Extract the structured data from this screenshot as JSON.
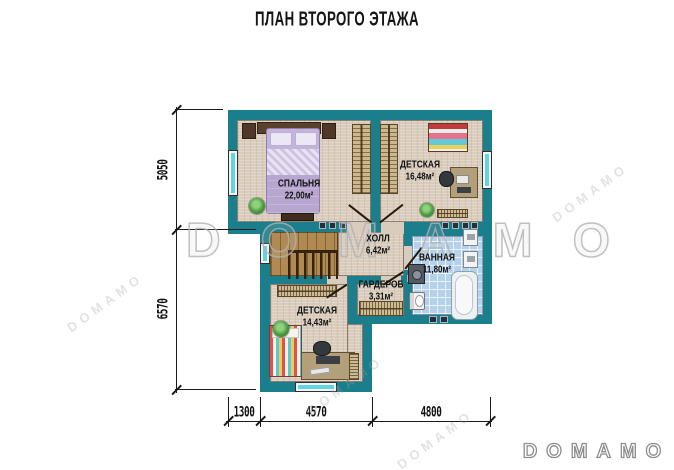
{
  "title": "ПЛАН ВТОРОГО ЭТАЖА",
  "rooms": [
    {
      "name": "СПАЛЬНЯ",
      "area": "22,00м²"
    },
    {
      "name": "ДЕТСКАЯ",
      "area": "16,48м²"
    },
    {
      "name": "ХОЛЛ",
      "area": "6,42м²"
    },
    {
      "name": "ВАННАЯ",
      "area": "11,80м²"
    },
    {
      "name": "ГАРДЕРОБ",
      "area": "3,31м²"
    },
    {
      "name": "ДЕТСКАЯ",
      "area": "14,43м²"
    }
  ],
  "dimensions": {
    "left": [
      "5050",
      "6570"
    ],
    "bottom": [
      "1300",
      "4570",
      "4800"
    ]
  },
  "watermark": {
    "main": "DOMAMO",
    "tile": "DOMAMO",
    "logo": "DOMAMO"
  },
  "colors": {
    "wall": "#1b7e8c",
    "floor": "#d9ccbd",
    "tile": "#b6d1ec",
    "wood": "#b08a52",
    "glass": "#5fd4e4"
  }
}
